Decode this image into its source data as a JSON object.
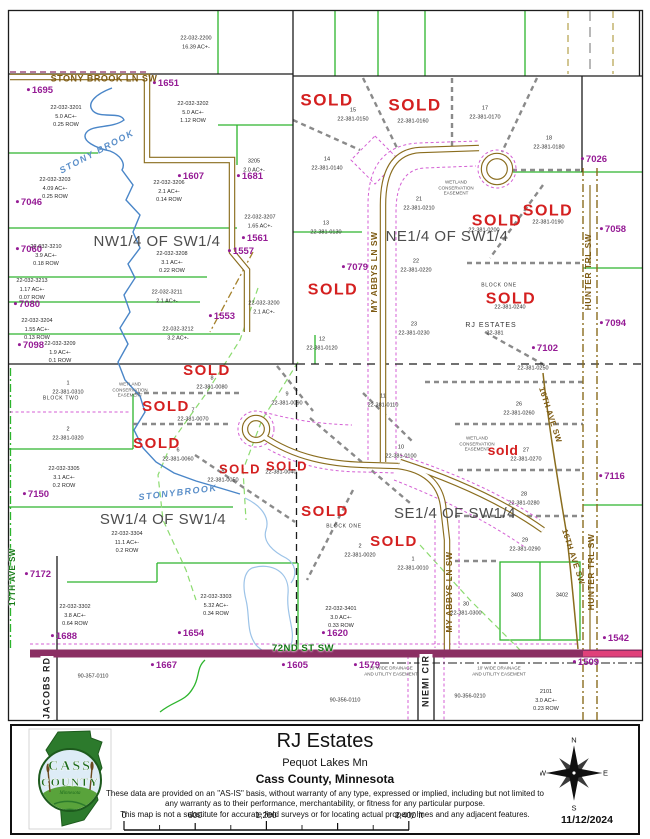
{
  "map": {
    "labels": [
      {
        "t": "NW1/4 OF SW1/4",
        "x": 157,
        "y": 242,
        "c": "q"
      },
      {
        "t": "NE1/4 OF SW1/4",
        "x": 447,
        "y": 237,
        "c": "q"
      },
      {
        "t": "SW1/4 OF SW1/4",
        "x": 163,
        "y": 520,
        "c": "q"
      },
      {
        "t": "SE1/4 OF SW1/4",
        "x": 455,
        "y": 514,
        "c": "q"
      },
      {
        "t": "SOLD",
        "x": 327,
        "y": 101,
        "c": "sold",
        "s": 17
      },
      {
        "t": "SOLD",
        "x": 415,
        "y": 106,
        "c": "sold",
        "s": 17
      },
      {
        "t": "SOLD",
        "x": 548,
        "y": 211,
        "c": "sold",
        "s": 16
      },
      {
        "t": "SOLD",
        "x": 497,
        "y": 221,
        "c": "sold",
        "s": 16
      },
      {
        "t": "SOLD",
        "x": 333,
        "y": 290,
        "c": "sold",
        "s": 16
      },
      {
        "t": "SOLD",
        "x": 511,
        "y": 299,
        "c": "sold",
        "s": 16
      },
      {
        "t": "SOLD",
        "x": 207,
        "y": 371,
        "c": "sold"
      },
      {
        "t": "SOLD",
        "x": 166,
        "y": 407,
        "c": "sold"
      },
      {
        "t": "SOLD",
        "x": 157,
        "y": 444,
        "c": "sold"
      },
      {
        "t": "SOLD",
        "x": 240,
        "y": 470,
        "c": "sold",
        "s": 13
      },
      {
        "t": "SOLD",
        "x": 287,
        "y": 467,
        "c": "sold",
        "s": 13
      },
      {
        "t": "sold",
        "x": 503,
        "y": 450,
        "c": "soldl"
      },
      {
        "t": "SOLD",
        "x": 325,
        "y": 512,
        "c": "sold"
      },
      {
        "t": "SOLD",
        "x": 394,
        "y": 542,
        "c": "sold"
      },
      {
        "t": "1695",
        "x": 40,
        "y": 91,
        "c": "addr"
      },
      {
        "t": "1651",
        "x": 166,
        "y": 84,
        "c": "addr"
      },
      {
        "t": "1607",
        "x": 191,
        "y": 177,
        "c": "addr"
      },
      {
        "t": "1681",
        "x": 250,
        "y": 177,
        "c": "addr"
      },
      {
        "t": "7046",
        "x": 29,
        "y": 203,
        "c": "addr"
      },
      {
        "t": "7060",
        "x": 29,
        "y": 250,
        "c": "addr"
      },
      {
        "t": "7080",
        "x": 27,
        "y": 305,
        "c": "addr"
      },
      {
        "t": "7098",
        "x": 31,
        "y": 346,
        "c": "addr"
      },
      {
        "t": "1557",
        "x": 241,
        "y": 252,
        "c": "addr"
      },
      {
        "t": "1561",
        "x": 255,
        "y": 239,
        "c": "addr"
      },
      {
        "t": "1553",
        "x": 222,
        "y": 317,
        "c": "addr"
      },
      {
        "t": "7026",
        "x": 594,
        "y": 160,
        "c": "addr"
      },
      {
        "t": "7058",
        "x": 613,
        "y": 230,
        "c": "addr"
      },
      {
        "t": "7079",
        "x": 355,
        "y": 268,
        "c": "addr"
      },
      {
        "t": "7094",
        "x": 613,
        "y": 324,
        "c": "addr"
      },
      {
        "t": "7102",
        "x": 545,
        "y": 349,
        "c": "addr"
      },
      {
        "t": "7116",
        "x": 612,
        "y": 477,
        "c": "addr"
      },
      {
        "t": "7150",
        "x": 36,
        "y": 495,
        "c": "addr"
      },
      {
        "t": "7172",
        "x": 38,
        "y": 575,
        "c": "addr"
      },
      {
        "t": "1688",
        "x": 64,
        "y": 637,
        "c": "addr"
      },
      {
        "t": "1654",
        "x": 191,
        "y": 634,
        "c": "addr"
      },
      {
        "t": "1667",
        "x": 164,
        "y": 666,
        "c": "addr"
      },
      {
        "t": "1605",
        "x": 295,
        "y": 666,
        "c": "addr"
      },
      {
        "t": "1620",
        "x": 335,
        "y": 634,
        "c": "addr"
      },
      {
        "t": "1579",
        "x": 367,
        "y": 666,
        "c": "addr"
      },
      {
        "t": "1509",
        "x": 586,
        "y": 663,
        "c": "addr"
      },
      {
        "t": "1542",
        "x": 616,
        "y": 639,
        "c": "addr"
      },
      {
        "t": "22-032-2200\n16.39 AC+-",
        "x": 196,
        "y": 43,
        "c": "pid"
      },
      {
        "t": "22-032-3201\n5.0 AC+-\n0.25 ROW",
        "x": 66,
        "y": 117,
        "c": "pid"
      },
      {
        "t": "22-032-3202\n5.0 AC+-\n1.12 ROW",
        "x": 193,
        "y": 113,
        "c": "pid"
      },
      {
        "t": "22-032-3203\n4.09 AC+-\n0.25 ROW",
        "x": 55,
        "y": 189,
        "c": "pid"
      },
      {
        "t": "22-032-3206\n2.1 AC+-\n0.14 ROW",
        "x": 169,
        "y": 192,
        "c": "pid"
      },
      {
        "t": "3205\n2.0 AC+-",
        "x": 254,
        "y": 166,
        "c": "pid"
      },
      {
        "t": "22-032-3207\n1.65 AC+-",
        "x": 260,
        "y": 222,
        "c": "pid"
      },
      {
        "t": "22-032-3210\n3.9 AC+-\n0.18 ROW",
        "x": 46,
        "y": 256,
        "c": "pid"
      },
      {
        "t": "22-032-3208\n3.1 AC+-\n0.22 ROW",
        "x": 172,
        "y": 263,
        "c": "pid"
      },
      {
        "t": "22-032-3213\n1.17 AC+-\n0.07 ROW",
        "x": 32,
        "y": 290,
        "c": "pid"
      },
      {
        "t": "22-032-3204\n1.55 AC+-\n0.13 ROW",
        "x": 37,
        "y": 330,
        "c": "pid"
      },
      {
        "t": "22-032-3211\n2.1 AC+-",
        "x": 167,
        "y": 297,
        "c": "pid"
      },
      {
        "t": "22-032-3200\n2.1 AC+-",
        "x": 264,
        "y": 308,
        "c": "pid"
      },
      {
        "t": "22-032-3209\n1.9 AC+-\n0.1 ROW",
        "x": 60,
        "y": 353,
        "c": "pid"
      },
      {
        "t": "22-032-3212\n3.2 AC+-",
        "x": 178,
        "y": 334,
        "c": "pid"
      },
      {
        "t": "22-032-3305\n3.1 AC+-\n0.2 ROW",
        "x": 64,
        "y": 478,
        "c": "pid"
      },
      {
        "t": "22-032-3304\n11.1 AC+-\n0.2 ROW",
        "x": 127,
        "y": 543,
        "c": "pid"
      },
      {
        "t": "22-032-3302\n3.8 AC+-\n0.64 ROW",
        "x": 75,
        "y": 616,
        "c": "pid"
      },
      {
        "t": "22-032-3303\n5.32 AC+-\n0.34 ROW",
        "x": 216,
        "y": 606,
        "c": "pid"
      },
      {
        "t": "90-357-0110",
        "x": 93,
        "y": 677,
        "c": "pid"
      },
      {
        "t": "22-032-3401\n3.0 AC+-\n0.33 ROW",
        "x": 341,
        "y": 618,
        "c": "pid"
      },
      {
        "t": "90-356-0110",
        "x": 345,
        "y": 701,
        "c": "pid"
      },
      {
        "t": "90-356-0210",
        "x": 470,
        "y": 697,
        "c": "pid"
      },
      {
        "t": "2101\n3.0 AC+-\n0.23 ROW",
        "x": 546,
        "y": 701,
        "c": "pid"
      },
      {
        "t": "3403",
        "x": 517,
        "y": 596,
        "c": "pid"
      },
      {
        "t": "3402",
        "x": 562,
        "y": 596,
        "c": "pid"
      },
      {
        "t": "15\n22-381-0150",
        "x": 353,
        "y": 115,
        "c": "pid"
      },
      {
        "t": "22-381-0160",
        "x": 413,
        "y": 122,
        "c": "pid"
      },
      {
        "t": "17\n22-381-0170",
        "x": 485,
        "y": 113,
        "c": "pid"
      },
      {
        "t": "18\n22-381-0180",
        "x": 549,
        "y": 143,
        "c": "pid"
      },
      {
        "t": "14\n22-381-0140",
        "x": 327,
        "y": 164,
        "c": "pid"
      },
      {
        "t": "13\n22-381-0130",
        "x": 326,
        "y": 228,
        "c": "pid"
      },
      {
        "t": "21\n22-381-0210",
        "x": 419,
        "y": 204,
        "c": "pid"
      },
      {
        "t": "22-381-0190",
        "x": 548,
        "y": 223,
        "c": "pid"
      },
      {
        "t": "22-381-0200",
        "x": 484,
        "y": 231,
        "c": "pid"
      },
      {
        "t": "22\n22-381-0220",
        "x": 416,
        "y": 266,
        "c": "pid"
      },
      {
        "t": "23\n22-381-0230",
        "x": 414,
        "y": 329,
        "c": "pid"
      },
      {
        "t": "12\n22-381-0120",
        "x": 322,
        "y": 344,
        "c": "pid"
      },
      {
        "t": "22-381-0240",
        "x": 510,
        "y": 308,
        "c": "pid"
      },
      {
        "t": "22-381-0250",
        "x": 533,
        "y": 369,
        "c": "pid"
      },
      {
        "t": "11\n22-381-0110",
        "x": 383,
        "y": 401,
        "c": "pid"
      },
      {
        "t": "8\n22-381-0080",
        "x": 212,
        "y": 383,
        "c": "pid"
      },
      {
        "t": "7\n22-381-0070",
        "x": 193,
        "y": 415,
        "c": "pid"
      },
      {
        "t": "6\n22-381-0060",
        "x": 178,
        "y": 455,
        "c": "pid"
      },
      {
        "t": "9\n22-381-0090",
        "x": 287,
        "y": 399,
        "c": "pid"
      },
      {
        "t": "5\n22-381-0050",
        "x": 223,
        "y": 476,
        "c": "pid"
      },
      {
        "t": "22-381-0040",
        "x": 281,
        "y": 473,
        "c": "pid"
      },
      {
        "t": "10\n22-381-0100",
        "x": 401,
        "y": 452,
        "c": "pid"
      },
      {
        "t": "26\n22-381-0260",
        "x": 519,
        "y": 409,
        "c": "pid"
      },
      {
        "t": "27\n22-381-0270",
        "x": 526,
        "y": 455,
        "c": "pid"
      },
      {
        "t": "28\n22-381-0280",
        "x": 524,
        "y": 499,
        "c": "pid"
      },
      {
        "t": "29\n22-381-0290",
        "x": 525,
        "y": 545,
        "c": "pid"
      },
      {
        "t": "30\n22-381-0300",
        "x": 466,
        "y": 609,
        "c": "pid"
      },
      {
        "t": "1\n22-381-0010",
        "x": 413,
        "y": 564,
        "c": "pid"
      },
      {
        "t": "2\n22-381-0020",
        "x": 360,
        "y": 551,
        "c": "pid"
      },
      {
        "t": "1\n22-381-0310",
        "x": 68,
        "y": 388,
        "c": "pid"
      },
      {
        "t": "2\n22-381-0320",
        "x": 68,
        "y": 434,
        "c": "pid"
      },
      {
        "t": "22-381",
        "x": 495,
        "y": 334,
        "c": "pid"
      },
      {
        "t": "BLOCK ONE",
        "x": 499,
        "y": 286,
        "c": "blk"
      },
      {
        "t": "BLOCK ONE",
        "x": 344,
        "y": 527,
        "c": "blk"
      },
      {
        "t": "BLOCK TWO",
        "x": 61,
        "y": 399,
        "c": "blk"
      },
      {
        "t": "RJ ESTATES",
        "x": 491,
        "y": 326,
        "c": "est"
      },
      {
        "t": "WETLAND\nCONSERVATION\nEASEMENT",
        "x": 456,
        "y": 188,
        "c": "note"
      },
      {
        "t": "WETLAND\nCONSERVATION\nEASEMENT",
        "x": 130,
        "y": 390,
        "c": "note"
      },
      {
        "t": "WETLAND\nCONSERVATION\nEASEMENT",
        "x": 477,
        "y": 444,
        "c": "note"
      },
      {
        "t": "10' WIDE DRAINAGE\nAND UTILITY EASEMENT",
        "x": 391,
        "y": 671,
        "c": "note"
      },
      {
        "t": "10' WIDE DRAINAGE\nAND UTILITY EASEMENT",
        "x": 499,
        "y": 671,
        "c": "note"
      },
      {
        "t": "STONY BROOK LN SW",
        "x": 104,
        "y": 79,
        "c": "rd",
        "s": 9
      },
      {
        "t": "STONY BROOK",
        "x": 97,
        "y": 152,
        "c": "stream",
        "r": -28
      },
      {
        "t": "STONYBROOK",
        "x": 178,
        "y": 493,
        "c": "stream",
        "r": -7
      },
      {
        "t": "MY ABBYS LN SW",
        "x": 374,
        "y": 272,
        "c": "rd",
        "r": -90
      },
      {
        "t": "MY ABBYS LN SW",
        "x": 449,
        "y": 592,
        "c": "rd",
        "r": -90
      },
      {
        "t": "NIEMI CIR",
        "x": 426,
        "y": 681,
        "c": "rdk",
        "r": -90
      },
      {
        "t": "JACOBS RD",
        "x": 47,
        "y": 688,
        "c": "rdk",
        "r": -90
      },
      {
        "t": "17TH AVE SW",
        "x": 13,
        "y": 577,
        "c": "rdg",
        "r": -90,
        "s": 8
      },
      {
        "t": "HUNTER TRL SW",
        "x": 588,
        "y": 272,
        "c": "rd",
        "r": -90
      },
      {
        "t": "HUNTER TRL SW",
        "x": 591,
        "y": 572,
        "c": "rd",
        "r": -90
      },
      {
        "t": "16TH AVE SW",
        "x": 550,
        "y": 415,
        "c": "rd",
        "r": 72,
        "s": 8
      },
      {
        "t": "16TH AVE SW",
        "x": 573,
        "y": 557,
        "c": "rd",
        "r": 72,
        "s": 8
      },
      {
        "t": "72ND ST SW",
        "x": 303,
        "y": 649,
        "c": "rdg"
      }
    ]
  },
  "footer": {
    "title": "RJ Estates",
    "subtitle": "Pequot Lakes Mn",
    "county": "Cass County, Minnesota",
    "disclaimer_line1": "These data are provided on an \"AS-IS\" basis, without warranty of any type, expressed or implied, including but not limited",
    "disclaimer_line2": "to any warranty as to their performance, merchantability, or fitness for any particular purpose.",
    "disclaimer_line3": "This map is not a substitute for accurate field surveys or for locating actual property lines and any adjacent features.",
    "scale": {
      "t0": "0",
      "t600": "600",
      "t1200": "1,200",
      "t2400": "2,400 ft"
    },
    "date": "11/12/2024",
    "compass": {
      "n": "N",
      "e": "E",
      "s": "S",
      "w": "W"
    },
    "logo": {
      "line1": "CASS",
      "line2": "COUNTY",
      "line3": "Minnesota"
    }
  },
  "colors": {
    "sold_red": "#d42020",
    "address_purple": "#951b95",
    "road_brown": "#8a6d1e",
    "street_72nd_maroon": "#8b2f63",
    "parcel_green": "#2db52d",
    "stream_blue": "#4a86c8"
  }
}
